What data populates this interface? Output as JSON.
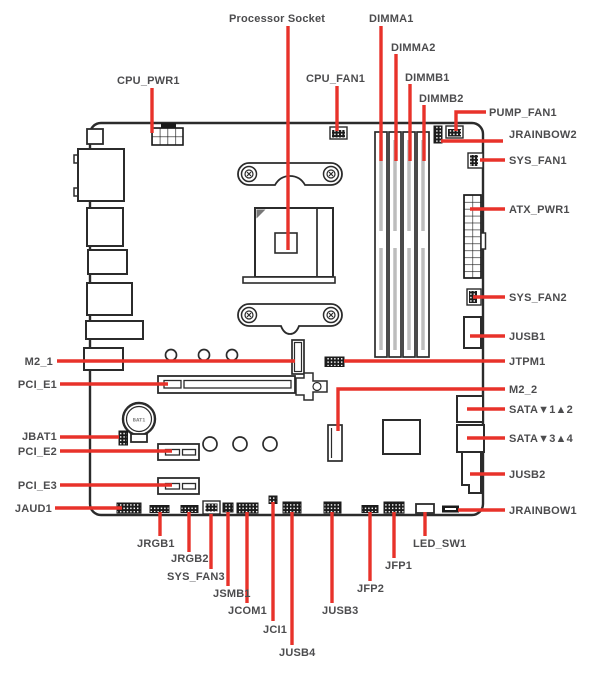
{
  "colors": {
    "red": "#e8322a",
    "ink": "#4c4c4e",
    "line": "#2b2b2b"
  },
  "board": {
    "battery_label": "BAT1"
  },
  "labels": {
    "processor_socket": "Processor Socket",
    "dimma1": "DIMMA1",
    "dimma2": "DIMMA2",
    "dimmb1": "DIMMB1",
    "dimmb2": "DIMMB2",
    "cpu_pwr1": "CPU_PWR1",
    "cpu_fan1": "CPU_FAN1",
    "pump_fan1": "PUMP_FAN1",
    "jrainbow2": "JRAINBOW2",
    "sys_fan1": "SYS_FAN1",
    "atx_pwr1": "ATX_PWR1",
    "sys_fan2": "SYS_FAN2",
    "jusb1": "JUSB1",
    "jtpm1": "JTPM1",
    "m2_2": "M2_2",
    "sata12": "SATA▼1▲2",
    "sata34": "SATA▼3▲4",
    "jusb2": "JUSB2",
    "jrainbow1": "JRAINBOW1",
    "m2_1": "M2_1",
    "pci_e1": "PCI_E1",
    "jbat1": "JBAT1",
    "pci_e2": "PCI_E2",
    "pci_e3": "PCI_E3",
    "jaud1": "JAUD1",
    "jrgb1": "JRGB1",
    "jrgb2": "JRGB2",
    "sys_fan3": "SYS_FAN3",
    "jsmb1": "JSMB1",
    "jcom1": "JCOM1",
    "jci1": "JCI1",
    "jusb4": "JUSB4",
    "jusb3": "JUSB3",
    "jfp2": "JFP2",
    "jfp1": "JFP1",
    "led_sw1": "LED_SW1"
  }
}
